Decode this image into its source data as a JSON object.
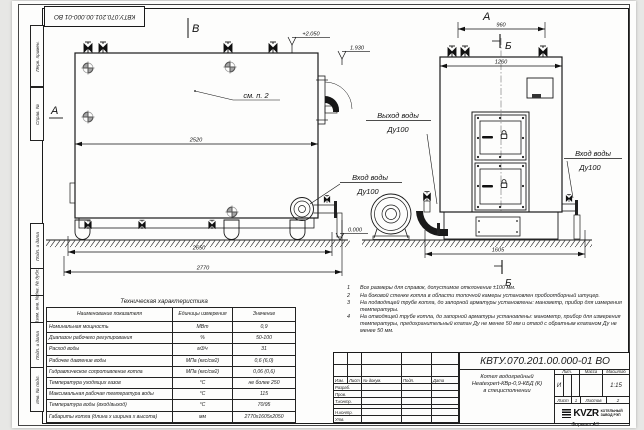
{
  "frame_labels": {
    "perv": "Перв. примен.",
    "sprav": "Справ. №",
    "podp1": "Подп. и дата",
    "inv_dubl": "Инв. № дубл.",
    "vzam": "Взам. инв. №",
    "podp2": "Подп. и дата",
    "inv_podl": "Инв. № подл."
  },
  "drawing": {
    "view_labels": {
      "a_left": "А",
      "v_top": "В",
      "a_right": "А",
      "b_top": "Б",
      "b_bottom": "Б"
    },
    "elevations": {
      "top": "+2.050",
      "mid": "1.930",
      "zero": "0.000"
    },
    "note_ref": "см. п. 2",
    "dims": {
      "d2520": "2520",
      "d2650": "2650",
      "d2770": "2770",
      "d960": "960",
      "d1260": "1260",
      "d1605": "1605"
    },
    "ports": {
      "outlet": [
        "Выход воды",
        "Ду100"
      ],
      "inlet_side": [
        "Вход воды",
        "Ду100"
      ],
      "inlet_right": [
        "Вход воды",
        "Ду100"
      ]
    }
  },
  "tech_table": {
    "title": "Техническая характеристика",
    "headers": [
      "Наименование показателя",
      "Единицы измерения",
      "Значение"
    ],
    "rows": [
      [
        "Номинальная мощность",
        "МВт",
        "0,9"
      ],
      [
        "Диапазон рабочего регулирования",
        "%",
        "50-100"
      ],
      [
        "Расход воды",
        "м3/ч",
        "31"
      ],
      [
        "Рабочее давление воды",
        "МПа (кгс/см2)",
        "0,6 (6,0)"
      ],
      [
        "Гидравлическое сопротивление котла",
        "МПа (кгс/см2)",
        "0,06 (0,6)"
      ],
      [
        "Температура уходящих газов",
        "°С",
        "не более 250"
      ],
      [
        "Максимальная рабочая температура воды",
        "°С",
        "115"
      ],
      [
        "Температура воды (вход/выход)",
        "°С",
        "70/95"
      ],
      [
        "Габариты котла (длина х ширина х высота)",
        "мм",
        "2770х1605х2050"
      ]
    ]
  },
  "notes": [
    {
      "num": "1",
      "text": "Все размеры для справок, допустимое отклонение  ±100 мм."
    },
    {
      "num": "2",
      "text": "На боковой стенке котла в области топочной камеры установлен пробоотборный штуцер."
    },
    {
      "num": "3",
      "text": "На  подводящей трубе котла, до запорной арматуры установлены: манометр, прибор для измерения температуры."
    },
    {
      "num": "4",
      "text": "На отводящей трубе котла, до запорной арматуры установлены: манометр, прибор для измерения температуры, предохранительный клапан  Ду не менее 50 мм и отвод с обратным клапаном  Ду не менее 50 мм."
    }
  ],
  "title_block": {
    "doc_number": "КВТУ.070.201.00.000-01  ВО",
    "name_line1": "Котел водогрейный",
    "name_line2": "Heatexpert-КВр-0,9-КБД (К)",
    "name_line3": "в специсполнении",
    "cols": {
      "izm": "Изм.",
      "list": "Лист",
      "doc": "№ докум.",
      "podp": "Подп.",
      "data": "Дата"
    },
    "roles": {
      "razrab": "Разраб.",
      "prov": "Пров.",
      "tkontr": "Т.контр.",
      "nkontr": "Н.контр.",
      "utv": "Утв."
    },
    "lit_header": "Лит.",
    "mass_header": "Масса",
    "scale_header": "Масштаб",
    "lit_value": "И",
    "scale_value": "1:15",
    "sheet_label": "Лист",
    "sheet_value": "1",
    "sheets_label": "Листов",
    "sheets_value": "2",
    "logo_word": "KVZR",
    "logo_caption_line1": "КОТЕЛЬНЫЙ",
    "logo_caption_line2": "ЗАВОД РЭП",
    "format": "Формат  А3"
  }
}
